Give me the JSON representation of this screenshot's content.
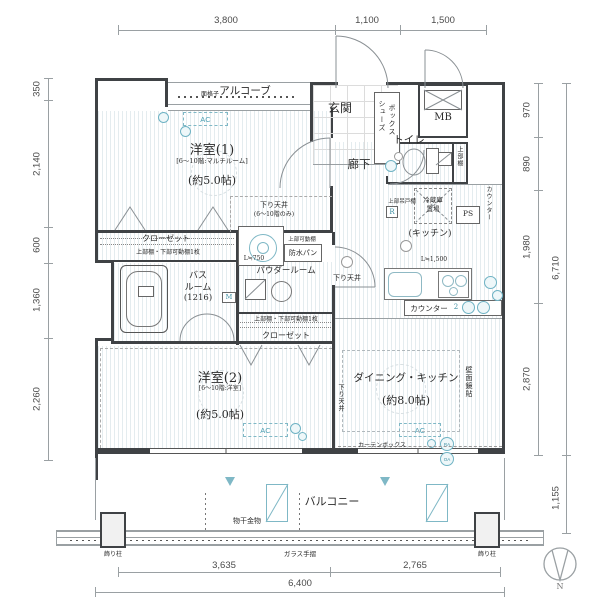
{
  "colors": {
    "teal": "#5FAFC2",
    "wall": "#3F4245"
  },
  "dimensions": {
    "top": [
      "3,800",
      "1,100",
      "1,500"
    ],
    "left": [
      "350",
      "2,140",
      "600",
      "1,360",
      "2,260"
    ],
    "right": [
      "970",
      "890",
      "1,980",
      "2,870"
    ],
    "right_total": "6,710",
    "balcony_depth": "1,155",
    "bottom": [
      "3,635",
      "2,765"
    ],
    "bottom_total": "6,400"
  },
  "rooms": {
    "alcove": {
      "name": "アルコーブ",
      "grille": "面格子"
    },
    "entrance": {
      "name": "玄関",
      "shoe_box_1": "シューズ",
      "shoe_box_2": "ボックス"
    },
    "mb": {
      "name": "MB"
    },
    "western1": {
      "name": "洋室(1)",
      "floor_note": "[6〜10階:マルチルーム]",
      "area": "(約5.0帖)"
    },
    "hallway": {
      "name": "廊下"
    },
    "toilet": {
      "name": "トイレ",
      "shelf": "上部棚"
    },
    "kitchen": {
      "name": "(キッチン)",
      "length": "L≒1,500",
      "counter": "カウンター",
      "ps": "PS",
      "fridge_1": "冷蔵庫",
      "fridge_2": "置場",
      "cupboard": "上部吊戸棚",
      "range_mark": "R",
      "counter2": "カウンター",
      "counter2_num": "2"
    },
    "closet1": {
      "name": "クローゼット",
      "shelf": "上部棚・下部可動棚1枚"
    },
    "bath": {
      "name_1": "バス",
      "name_2": "ルーム",
      "size": "(1216)",
      "meter_mark": "M"
    },
    "powder": {
      "name": "パウダールーム",
      "length": "L≒750",
      "pan": "防水パン",
      "pan_shelf": "上部可動棚"
    },
    "closet2": {
      "name": "クローゼット",
      "shelf": "上部棚・下部可動棚1枚"
    },
    "western2": {
      "name": "洋室(2)",
      "floor_note": "[6〜10階:洋室]",
      "area": "(約5.0帖)"
    },
    "dining": {
      "name": "ダイニング・キッチン",
      "area": "(約8.0帖)",
      "mirror": "壁面鏡貼",
      "curtain_box": "カーテンボックス",
      "lowered": "下り天井",
      "ra": "RA",
      "oa": "OA"
    },
    "balcony": {
      "name": "バルコニー",
      "laundry": "物干金物",
      "glass_rail": "ガラス手摺",
      "pillar_left": "飾り柱",
      "pillar_right": "飾り柱"
    }
  },
  "notes": {
    "lowered_1": "下り天井",
    "lowered_1_sub": "(6〜10階のみ)",
    "lowered_mid": "下り天井",
    "ac": "AC"
  },
  "compass": {
    "north": "N"
  }
}
